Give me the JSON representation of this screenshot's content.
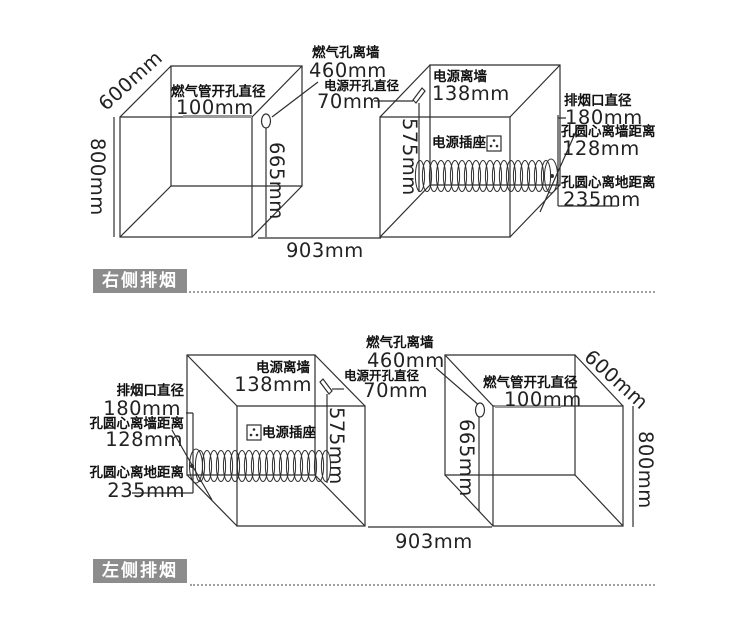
{
  "colors": {
    "line": "#2e2e2e",
    "badge_bg": "#8c8c8c",
    "badge_text": "#ffffff",
    "slot_line": "#9a9a9a",
    "dotted_line": "#a0a0a0"
  },
  "top": {
    "badge": "右侧排烟",
    "depth": "600mm",
    "height": "800mm",
    "width": "903mm",
    "gas_pipe_hole_label": "燃气管开孔直径",
    "gas_pipe_hole_value": "100mm",
    "gas_hole_height": "665mm",
    "gas_hole_wall_label": "燃气孔离墙",
    "gas_hole_wall_value": "460mm",
    "power_hole_label": "电源开孔直径",
    "power_hole_value": "70mm",
    "power_wall_label": "电源离墙",
    "power_wall_value": "138mm",
    "power_height": "575mm",
    "socket_label": "电源插座",
    "flue_dia_label": "排烟口直径",
    "flue_dia_value": "180mm",
    "flue_wall_label": "孔圆心离墙距离",
    "flue_wall_value": "128mm",
    "flue_floor_label": "孔圆心离地距离",
    "flue_floor_value": "235mm"
  },
  "bottom": {
    "badge": "左侧排烟",
    "depth": "600mm",
    "height": "800mm",
    "width": "903mm",
    "gas_pipe_hole_label": "燃气管开孔直径",
    "gas_pipe_hole_value": "100mm",
    "gas_hole_height": "665mm",
    "gas_hole_wall_label": "燃气孔离墙",
    "gas_hole_wall_value": "460mm",
    "power_hole_label": "电源开孔直径",
    "power_hole_value": "70mm",
    "power_wall_label": "电源离墙",
    "power_wall_value": "138mm",
    "power_height": "575mm",
    "socket_label": "电源插座",
    "flue_dia_label": "排烟口直径",
    "flue_dia_value": "180mm",
    "flue_wall_label": "孔圆心离墙距离",
    "flue_wall_value": "128mm",
    "flue_floor_label": "孔圆心离地距离",
    "flue_floor_value": "235mm"
  }
}
